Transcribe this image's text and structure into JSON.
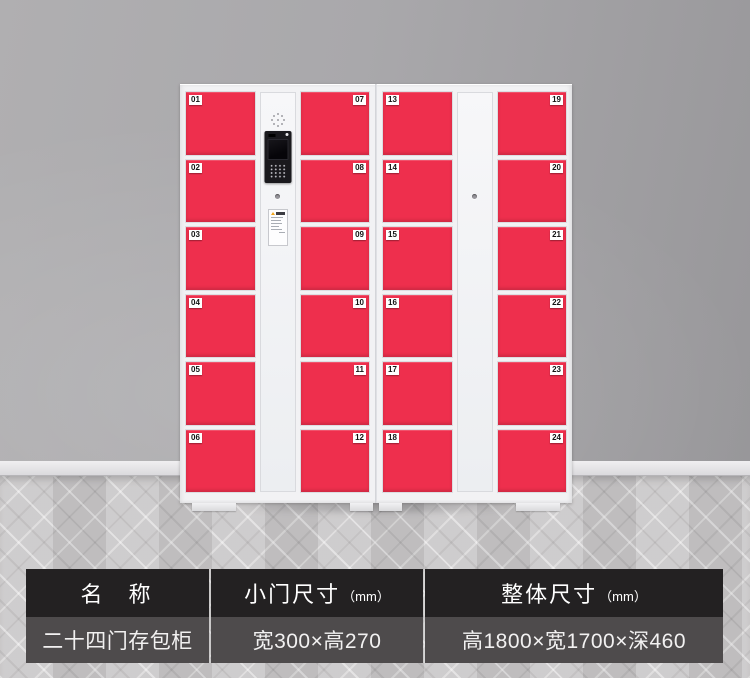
{
  "scene": {
    "type": "product-photo",
    "wall_color": "#a9a8ab",
    "floor_color": "#c9c7c8",
    "floor_style": "gray-herringbone-parquet"
  },
  "locker": {
    "body_color": "#f2f2f4",
    "door_color": "#ee2f4d",
    "door_count": 24,
    "door_columns": [
      {
        "plate_side": "left",
        "numbers": [
          "01",
          "02",
          "03",
          "04",
          "05",
          "06"
        ]
      },
      {
        "plate_side": "right",
        "numbers": [
          "07",
          "08",
          "09",
          "10",
          "11",
          "12"
        ]
      },
      {
        "plate_side": "left",
        "numbers": [
          "13",
          "14",
          "15",
          "16",
          "17",
          "18"
        ]
      },
      {
        "plate_side": "right",
        "numbers": [
          "19",
          "20",
          "21",
          "22",
          "23",
          "24"
        ]
      }
    ]
  },
  "spec_table": {
    "header_bg": "#232122",
    "row_bg": "#4e4b4c",
    "columns": [
      {
        "header": "名　称",
        "unit": "",
        "value": "二十四门存包柜"
      },
      {
        "header": "小门尺寸",
        "unit": "（mm）",
        "value": "宽300×高270"
      },
      {
        "header": "整体尺寸",
        "unit": "（mm）",
        "value": "高1800×宽1700×深460"
      }
    ]
  }
}
